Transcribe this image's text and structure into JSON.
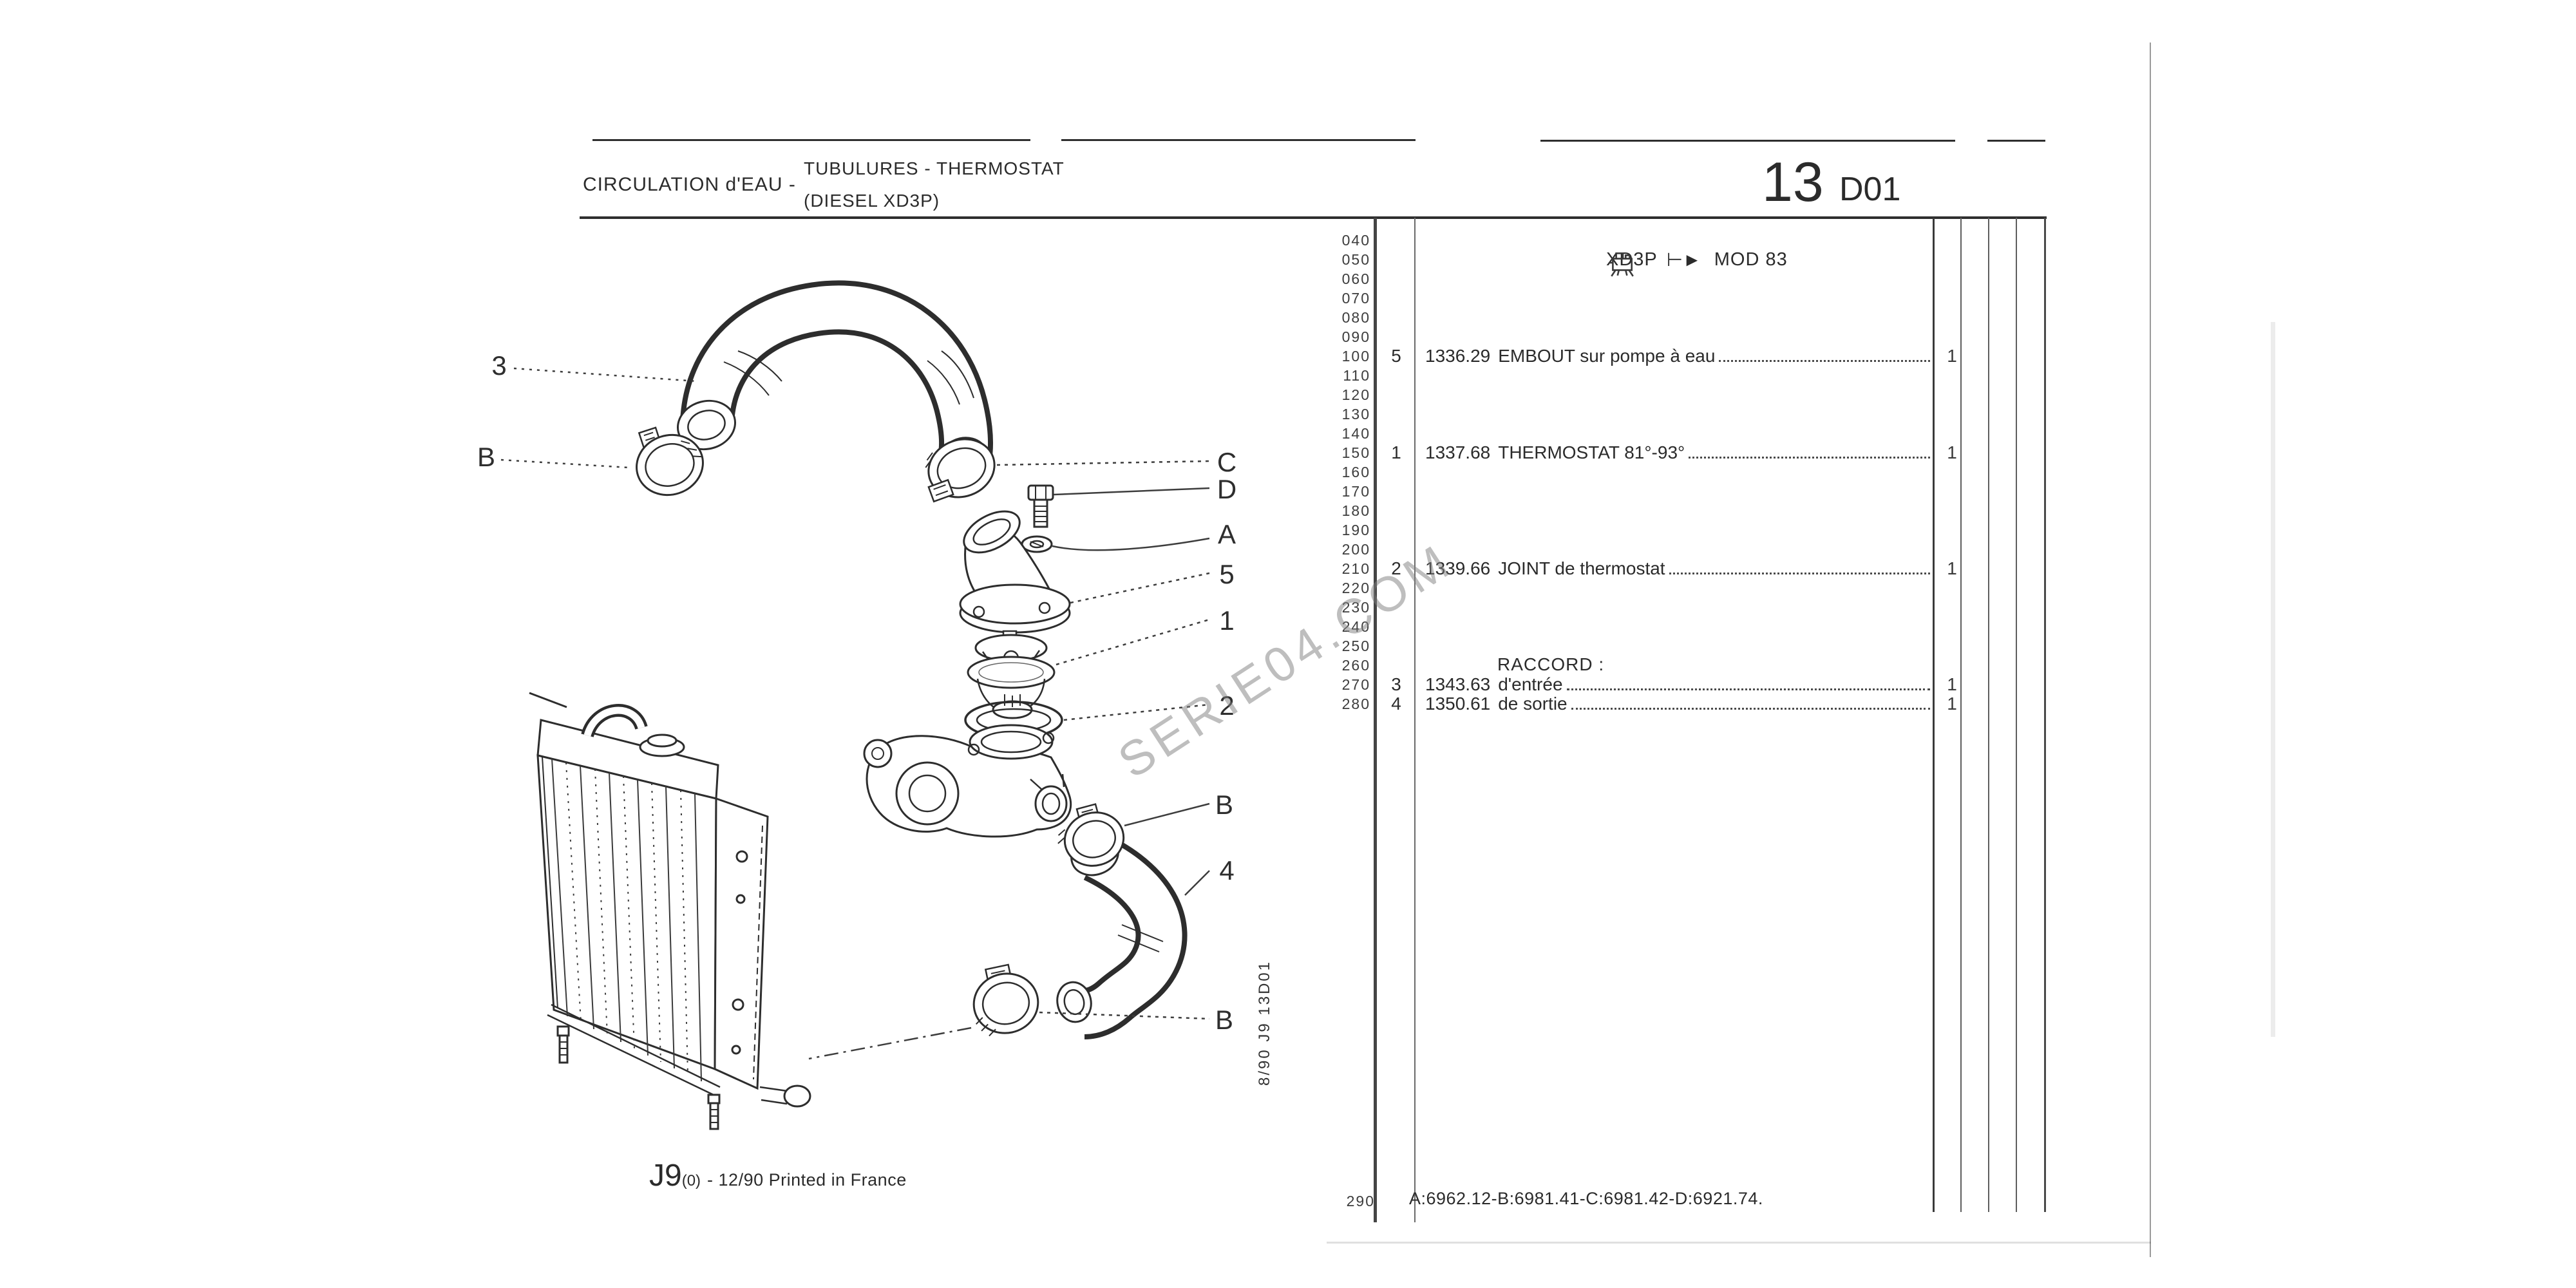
{
  "header": {
    "section_title": "CIRCULATION d'EAU -",
    "subject_line1": "TUBULURES - THERMOSTAT",
    "subject_line2": "(DIESEL XD3P)",
    "page_number": "13",
    "page_code": "D01"
  },
  "applicability": {
    "icon": "engine-icon",
    "engine": "XD3P",
    "arrow": "⊢►",
    "model": "MOD 83"
  },
  "parts_table": {
    "margin_scale": [
      "040",
      "050",
      "060",
      "070",
      "080",
      "090",
      "100",
      "110",
      "120",
      "130",
      "140",
      "150",
      "160",
      "170",
      "180",
      "190",
      "200",
      "210",
      "220",
      "230",
      "240",
      "250",
      "260",
      "270",
      "280"
    ],
    "margin_end": "290",
    "rows": [
      {
        "qty": "5",
        "ref": "1336.29",
        "label": "EMBOUT sur pompe à eau",
        "count": "1"
      },
      {
        "qty": "1",
        "ref": "1337.68",
        "label": "THERMOSTAT 81°-93°",
        "count": "1"
      },
      {
        "qty": "2",
        "ref": "1339.66",
        "label": "JOINT de thermostat",
        "count": "1"
      },
      {
        "qty": "3",
        "ref": "1343.63",
        "label": "d'entrée",
        "count": "1"
      },
      {
        "qty": "4",
        "ref": "1350.61",
        "label": "de sortie",
        "count": "1"
      }
    ],
    "group_header": "RACCORD :",
    "footnote": "A:6962.12-B:6981.41-C:6981.42-D:6921.74."
  },
  "diagram": {
    "callouts": [
      "3",
      "B",
      "C",
      "D",
      "A",
      "5",
      "1",
      "2",
      "B",
      "4",
      "B"
    ],
    "side_code": "8/90  J9  13D01",
    "watermark": "SERIE04.COM"
  },
  "footer": {
    "model": "J9",
    "variant": "(0)",
    "print_note": "- 12/90 Printed in France"
  }
}
